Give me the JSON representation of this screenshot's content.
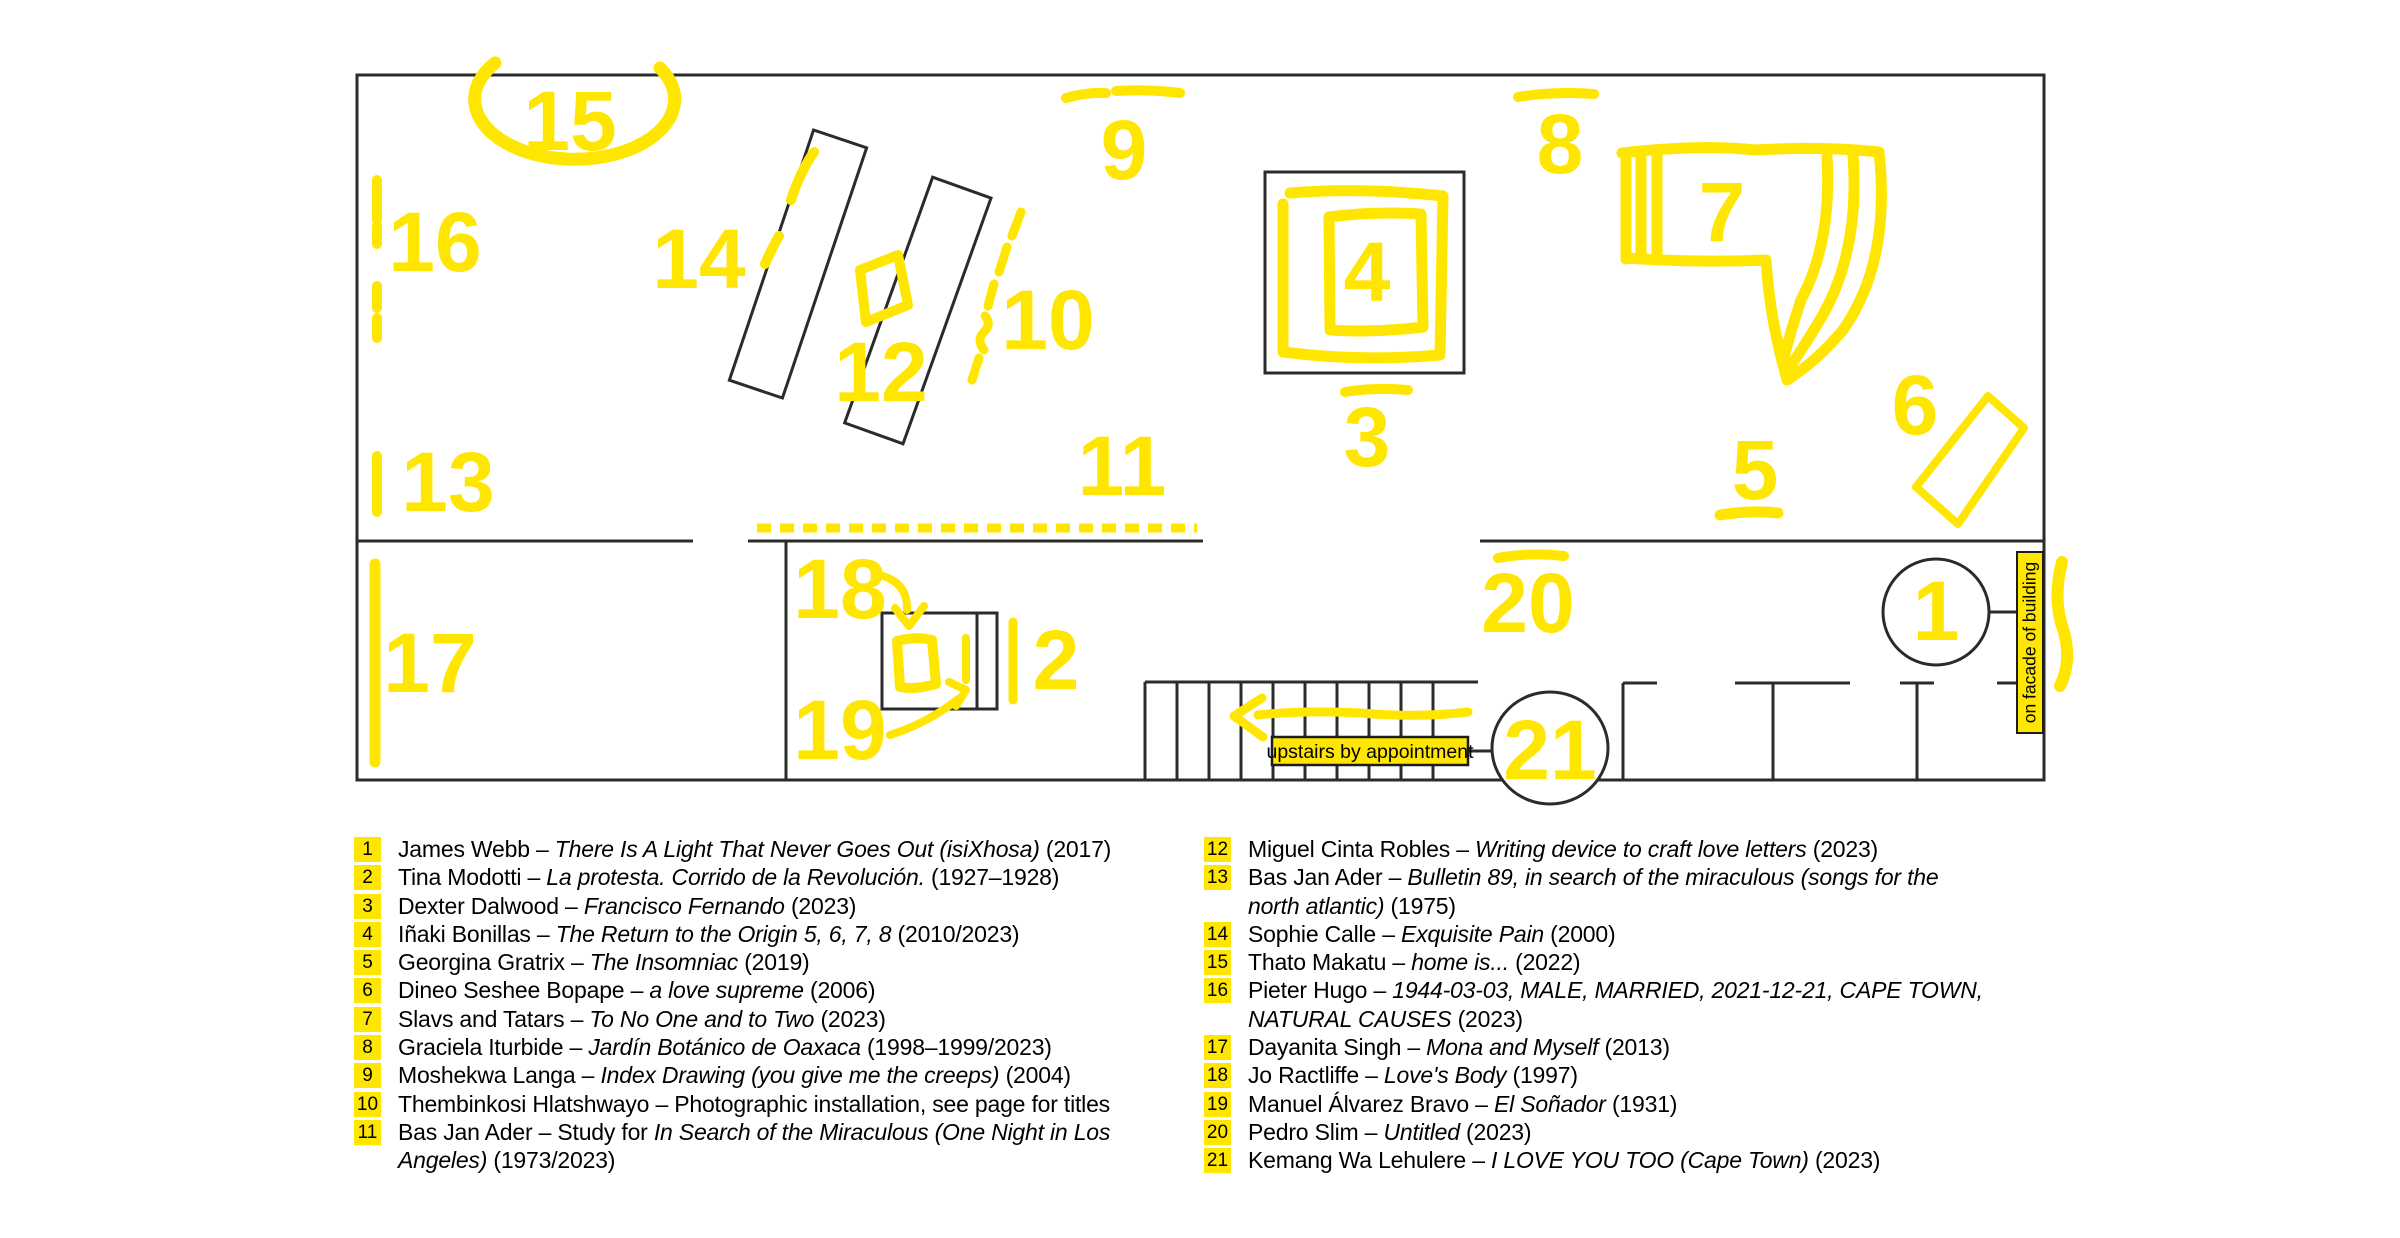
{
  "colors": {
    "yellow": "#FFE600",
    "wall": "#2B2B2B",
    "text": "#000000",
    "background": "#FFFFFF"
  },
  "plan": {
    "markers": [
      "1",
      "2",
      "3",
      "4",
      "5",
      "6",
      "7",
      "8",
      "9",
      "10",
      "11",
      "12",
      "13",
      "14",
      "15",
      "16",
      "17",
      "18",
      "19",
      "20",
      "21"
    ],
    "upstairs_label": "upstairs by appointment",
    "facade_label": "on facade of building"
  },
  "legend": {
    "columns": [
      [
        {
          "n": "1",
          "s": [
            {
              "t": "James Webb – "
            },
            {
              "t": "There Is A Light That Never Goes Out (isiXhosa)",
              "i": true
            },
            {
              "t": " (2017)"
            }
          ]
        },
        {
          "n": "2",
          "s": [
            {
              "t": "Tina Modotti – "
            },
            {
              "t": "La protesta. Corrido de la Revolución.",
              "i": true
            },
            {
              "t": " (1927–1928)"
            }
          ]
        },
        {
          "n": "3",
          "s": [
            {
              "t": "Dexter Dalwood – "
            },
            {
              "t": "Francisco Fernando",
              "i": true
            },
            {
              "t": " (2023)"
            }
          ]
        },
        {
          "n": "4",
          "s": [
            {
              "t": "Iñaki Bonillas – "
            },
            {
              "t": "The Return to the Origin 5, 6, 7, 8",
              "i": true
            },
            {
              "t": " (2010/2023)"
            }
          ]
        },
        {
          "n": "5",
          "s": [
            {
              "t": "Georgina Gratrix – "
            },
            {
              "t": "The Insomniac",
              "i": true
            },
            {
              "t": " (2019)"
            }
          ]
        },
        {
          "n": "6",
          "s": [
            {
              "t": "Dineo Seshee Bopape – "
            },
            {
              "t": "a love supreme",
              "i": true
            },
            {
              "t": " (2006)"
            }
          ]
        },
        {
          "n": "7",
          "s": [
            {
              "t": "Slavs and Tatars – "
            },
            {
              "t": "To No One and to Two",
              "i": true
            },
            {
              "t": " (2023)"
            }
          ]
        },
        {
          "n": "8",
          "s": [
            {
              "t": "Graciela Iturbide – "
            },
            {
              "t": "Jardín Botánico de Oaxaca",
              "i": true
            },
            {
              "t": " (1998–1999/2023)"
            }
          ]
        },
        {
          "n": "9",
          "s": [
            {
              "t": "Moshekwa Langa – "
            },
            {
              "t": "Index Drawing (you give me the creeps)",
              "i": true
            },
            {
              "t": " (2004)"
            }
          ]
        },
        {
          "n": "10",
          "s": [
            {
              "t": "Thembinkosi Hlatshwayo – Photographic installation, see page for titles"
            }
          ]
        },
        {
          "n": "11",
          "s": [
            {
              "t": "Bas Jan Ader – Study for "
            },
            {
              "t": "In Search of the Miraculous (One Night in Los",
              "i": true
            }
          ]
        },
        {
          "n": "",
          "s": [
            {
              "t": "Angeles)",
              "i": true
            },
            {
              "t": " (1973/2023)"
            }
          ]
        }
      ],
      [
        {
          "n": "12",
          "s": [
            {
              "t": "Miguel Cinta Robles – "
            },
            {
              "t": "Writing device to craft love letters",
              "i": true
            },
            {
              "t": " (2023)"
            }
          ]
        },
        {
          "n": "13",
          "s": [
            {
              "t": "Bas Jan Ader – "
            },
            {
              "t": "Bulletin 89, in search of the miraculous (songs for the",
              "i": true
            }
          ]
        },
        {
          "n": "",
          "s": [
            {
              "t": "north atlantic)",
              "i": true
            },
            {
              "t": " (1975)"
            }
          ]
        },
        {
          "n": "14",
          "s": [
            {
              "t": "Sophie Calle – "
            },
            {
              "t": "Exquisite Pain",
              "i": true
            },
            {
              "t": " (2000)"
            }
          ]
        },
        {
          "n": "15",
          "s": [
            {
              "t": "Thato Makatu – "
            },
            {
              "t": "home is...",
              "i": true
            },
            {
              "t": " (2022)"
            }
          ]
        },
        {
          "n": "16",
          "s": [
            {
              "t": "Pieter Hugo – "
            },
            {
              "t": "1944-03-03, MALE, MARRIED, 2021-12-21, CAPE TOWN,",
              "i": true
            }
          ]
        },
        {
          "n": "",
          "s": [
            {
              "t": "NATURAL CAUSES",
              "i": true
            },
            {
              "t": " (2023)"
            }
          ]
        },
        {
          "n": "17",
          "s": [
            {
              "t": "Dayanita Singh – "
            },
            {
              "t": "Mona and Myself",
              "i": true
            },
            {
              "t": " (2013)"
            }
          ]
        },
        {
          "n": "18",
          "s": [
            {
              "t": "Jo Ractliffe – "
            },
            {
              "t": "Love's Body",
              "i": true
            },
            {
              "t": " (1997)"
            }
          ]
        },
        {
          "n": "19",
          "s": [
            {
              "t": "Manuel Álvarez Bravo – "
            },
            {
              "t": "El Soñador",
              "i": true
            },
            {
              "t": " (1931)"
            }
          ]
        },
        {
          "n": "20",
          "s": [
            {
              "t": "Pedro Slim – "
            },
            {
              "t": "Untitled",
              "i": true
            },
            {
              "t": " (2023)"
            }
          ]
        },
        {
          "n": "21",
          "s": [
            {
              "t": "Kemang Wa Lehulere – "
            },
            {
              "t": "I LOVE YOU TOO (Cape Town)",
              "i": true
            },
            {
              "t": " (2023)"
            }
          ]
        }
      ]
    ]
  }
}
